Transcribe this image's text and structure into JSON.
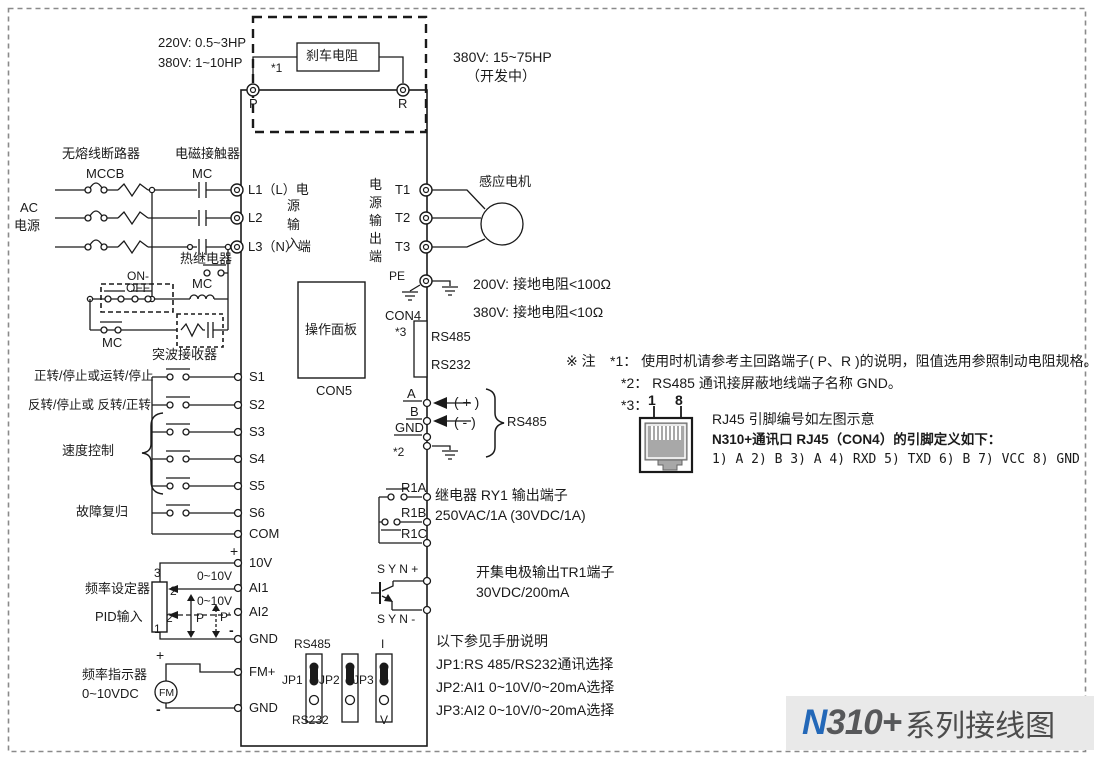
{
  "colors": {
    "accent_blue": "#2368b8",
    "title_dark": "#57585a",
    "band_bg": "#e9e9e9",
    "line": "#1a1a1a"
  },
  "title": {
    "n": "N",
    "rest": "310+",
    "suffix": "系列接线图"
  },
  "brake": {
    "rating_left_1": "220V: 0.5~3HP",
    "rating_left_2": "380V: 1~10HP",
    "resistor": "刹车电阻",
    "star": "*1",
    "p": "P",
    "r": "R",
    "rating_right_1": "380V: 15~75HP",
    "rating_right_2": "（开发中）"
  },
  "supply": {
    "breaker_name": "无熔线断路器",
    "breaker": "MCCB",
    "contactor_name": "电磁接触器",
    "contactor": "MC",
    "ac_1": "AC",
    "ac_2": "电源",
    "thermal": "热继电器",
    "onoff": "ON-\nOFF",
    "mc_coil": "MC",
    "mc_hold": "MC",
    "surge": "突波接收器"
  },
  "input_side": {
    "l1": "L1（L）电",
    "vert": "源\n输\n入",
    "l2": "L2",
    "l3": "L3（N）端",
    "s1_desc": "正转/停止或运转/停止",
    "s2_desc": "反转/停止或 反转/正转",
    "speed": "速度控制",
    "fault": "故障复归",
    "s1": "S1",
    "s2": "S2",
    "s3": "S3",
    "s4": "S4",
    "s5": "S5",
    "s6": "S6",
    "com": "COM",
    "plus": "+",
    "v10": "10V",
    "freq_setter": "频率设定器",
    "pid": "PID输入",
    "pin3": "3",
    "pin2": "2",
    "pin2p": "2'",
    "pin1": "1",
    "range1": "0~10V",
    "range2": "0~10V",
    "ai1": "AI1",
    "ai2": "AI2",
    "p": "P",
    "pp": "P'",
    "minus": "-",
    "gnd": "GND",
    "fm_plus": "+",
    "fm": "FM",
    "freq_indicator": "频率指示器",
    "vdc": "0~10VDC",
    "fm_minus": "-",
    "fm_term": "FM+",
    "gnd2": "GND"
  },
  "output_side": {
    "vert": "电\n源\n输\n出\n端",
    "t1": "T1",
    "t2": "T2",
    "t3": "T3",
    "motor": "感应电机",
    "pe": "PE",
    "gnd_200": "200V: 接地电阻<100Ω",
    "gnd_380": "380V: 接地电阻<10Ω"
  },
  "panel": {
    "label": "操作面板",
    "con5": "CON5",
    "con4": "CON4",
    "star3": "*3",
    "rs485": "RS485",
    "rs232": "RS232"
  },
  "comm": {
    "a": "A",
    "b": "B",
    "gnd": "GND",
    "star2": "*2",
    "plus": "( + )",
    "minus": "( - )",
    "rs485": "RS485"
  },
  "relay": {
    "r1a": "R1A",
    "r1b": "R1B",
    "r1c": "R1C",
    "desc1": "继电器 RY1 输出端子",
    "desc2": "250VAC/1A (30VDC/1A)"
  },
  "tr1": {
    "syn_plus": "S Y N +",
    "syn_minus": "S Y N -",
    "desc1": "开集电极输出TR1端子",
    "desc2": "30VDC/200mA"
  },
  "jumpers": {
    "rs485": "RS485",
    "i": "I",
    "jp1": "JP1",
    "jp2": "JP2",
    "jp3": "JP3",
    "rs232": "RS232",
    "v": "V",
    "note": "以下参见手册说明",
    "jp1_desc": "JP1:RS 485/RS232通讯选择",
    "jp2_desc": "JP2:AI1 0~10V/0~20mA选择",
    "jp3_desc": "JP3:AI2 0~10V/0~20mA选择"
  },
  "notes": {
    "mark": "※ 注",
    "n1": "*1： 使用时机请参考主回路端子( P、R )的说明，阻值选用参照制动电阻规格。",
    "n2": "*2： RS485 通讯接屏蔽地线端子名称 GND。",
    "n3": "*3：",
    "rj_pin1": "1",
    "rj_pin8": "8",
    "rj45_caption": "RJ45 引脚编号如左图示意",
    "rj45_def": "N310+通讯口 RJ45（CON4）的引脚定义如下：",
    "pins": "1) A   2) B   3) A   4) RXD   5) TXD   6) B   7) VCC   8) GND"
  }
}
